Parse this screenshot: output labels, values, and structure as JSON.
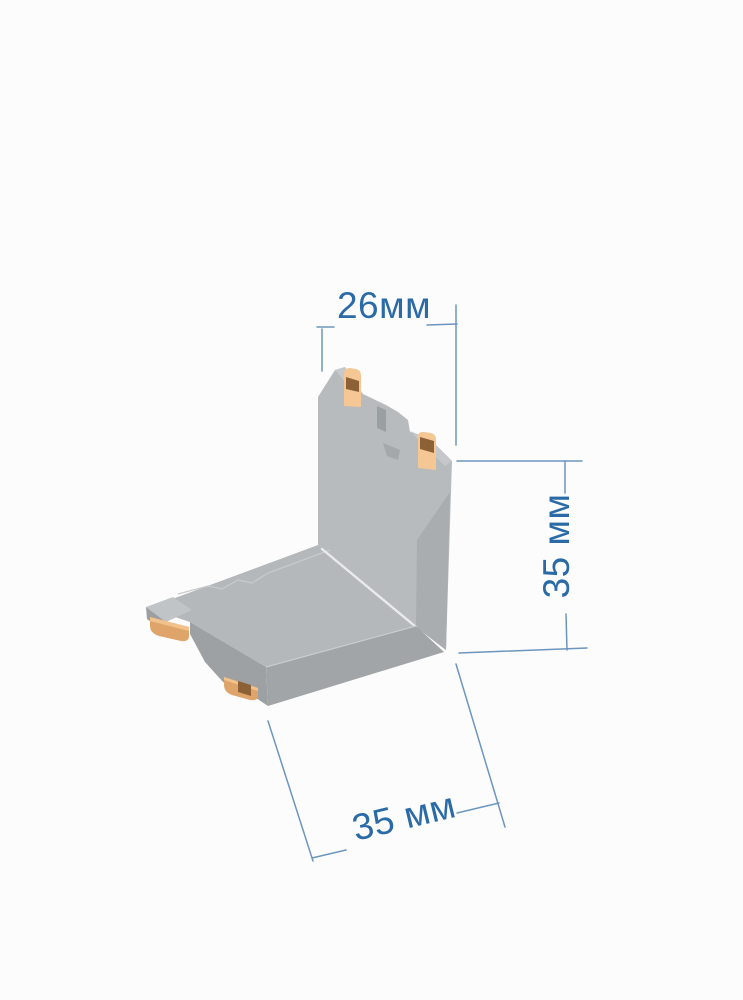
{
  "page": {
    "background_color": "#fcfcfc",
    "kind": "product dimension diagram"
  },
  "product_diagram": {
    "subject": "L-shaped corner connector (gray body with copper contact tabs), 3D perspective render",
    "colors": {
      "annotation_text": "#2a6aa6",
      "annotation_line": "#5d8bb8",
      "body_top_light": "#c7cacc",
      "body_front_mid": "#b7bbbd",
      "plate_top": "#b4b8ba",
      "body_side_dark": "#a1a5a7",
      "body_side_darker": "#9da1a3",
      "slot_shadow": "#9aa0a2",
      "contact_light": "#f2c28c",
      "contact_mid": "#dfa46a",
      "contact_dark": "#8d6136"
    },
    "dimensions": {
      "top_width": {
        "label": "26мм",
        "value": 26,
        "unit": "мм",
        "orientation": "horizontal"
      },
      "right_height": {
        "label": "35 мм",
        "value": 35,
        "unit": "мм",
        "orientation": "vertical"
      },
      "bottom_depth": {
        "label": "35 мм",
        "value": 35,
        "unit": "мм",
        "orientation": "diagonal"
      }
    }
  }
}
